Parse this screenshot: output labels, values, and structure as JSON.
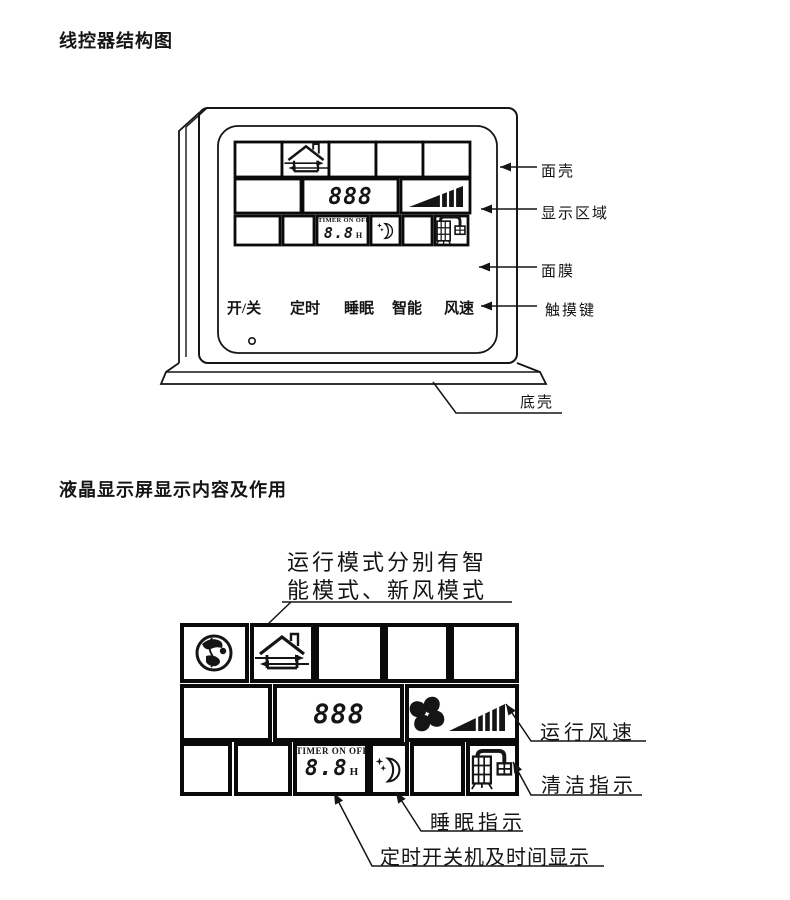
{
  "page": {
    "background": "#ffffff",
    "ink": "#151515"
  },
  "section1": {
    "title": "线控器结构图",
    "touch_keys": [
      {
        "label": "开/关"
      },
      {
        "label": "定时"
      },
      {
        "label": "睡眠"
      },
      {
        "label": "智能"
      },
      {
        "label": "风速"
      }
    ],
    "callouts": {
      "front_shell": "面壳",
      "display_area": "显示区域",
      "membrane": "面膜",
      "touch_keys": "触摸键",
      "bottom_shell": "底壳"
    },
    "lcd": {
      "mode_digits": "888",
      "timer_caption": "TIMER ON OFF",
      "timer_digits": "8.8",
      "timer_unit": "H"
    }
  },
  "section2": {
    "title": "液晶显示屏显示内容及作用",
    "mode_note": {
      "line1": "运行模式分别有智",
      "line2": "能模式、新风模式"
    },
    "callouts": {
      "fan_speed": "运行风速",
      "clean": "清洁指示",
      "sleep": "睡眠指示",
      "timer": "定时开关机及时间显示"
    },
    "lcd": {
      "mode_digits": "888",
      "timer_caption": "TIMER ON OFF",
      "timer_digits": "8.8",
      "timer_unit": "H"
    }
  },
  "icons": {
    "globe-icon": "earth globe — smart mode symbol",
    "house-icon": "house with airflow arrows — fresh-air mode symbol",
    "fan-icon": "four-blade fan — running fan",
    "fan-speed-bars-icon": "rising wedge with bars — fan speed level",
    "moon-icon": "crescent moon with stars — sleep",
    "clean-icon": "filter machine — cleaning indicator",
    "power-led-icon": "small indicator dot",
    "callout-arrow-icon": "solid leader arrowhead"
  }
}
